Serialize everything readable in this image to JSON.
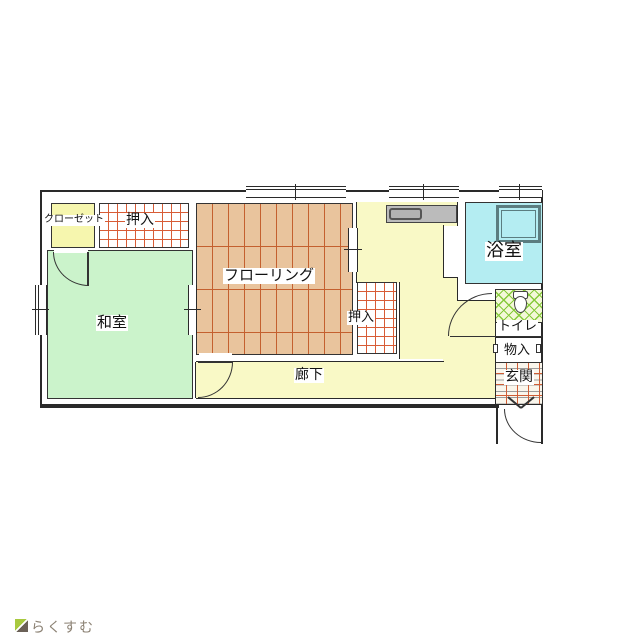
{
  "plan_title": "floor-plan",
  "rooms": {
    "closet": {
      "label": "クローゼット"
    },
    "oshiire_top": {
      "label": "押入"
    },
    "washitsu": {
      "label": "和室"
    },
    "flooring": {
      "label": "フローリング"
    },
    "oshiire_right": {
      "label": "押入"
    },
    "corridor": {
      "label": "廊下"
    },
    "bathroom": {
      "label": "浴室"
    },
    "toilet": {
      "label": "トイレ"
    },
    "storage": {
      "label": "物入"
    },
    "entrance": {
      "label": "玄関"
    }
  },
  "colors": {
    "washitsu_green": "#cbf3cb",
    "corridor_yellow": "#f9f9c6",
    "closet_yellow": "#f6f6ae",
    "bath_cyan": "#b4edf2",
    "wood_tan": "#e9c49d",
    "wood_line": "#c4602f",
    "grid_line_red": "#d85c36",
    "hatch_green": "#86ca3a",
    "wall_black": "#2a2a2a",
    "counter_gray": "#bbbbbb",
    "tub_border": "#5b7d80",
    "logo_gray": "#8b8173",
    "logo_roof_green": "#a8c93f"
  },
  "branding": {
    "logo_text": "らくすむ"
  }
}
